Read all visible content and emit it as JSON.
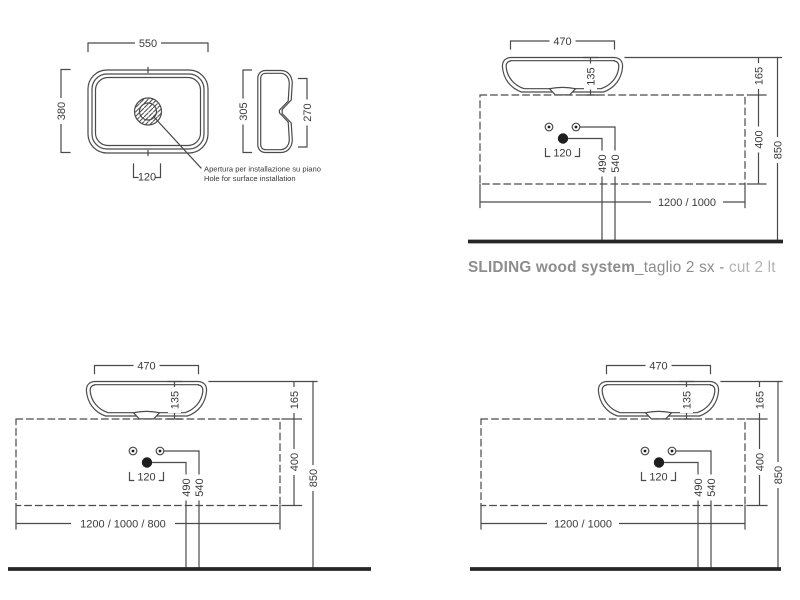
{
  "colors": {
    "background": "#ffffff",
    "line": "#4a4a4a",
    "floor": "#262626",
    "dim_text": "#3a3a3a",
    "caption_primary": "#8d8d8d",
    "caption_secondary": "#b3b3b3"
  },
  "caption": {
    "product": "SLIDING wood system",
    "cut_it": "_taglio 2 sx - ",
    "cut_en": "cut 2 lt"
  },
  "plan_view": {
    "width": "550",
    "depth": "380",
    "hole_width": "120",
    "note_line1": "Apertura per installazione su piano",
    "note_line2": "Hole for surface installation"
  },
  "side_view": {
    "height_total": "305",
    "height_inner": "270"
  },
  "elevations": {
    "top_right": {
      "basin_width": "470",
      "basin_height": "135",
      "rim_above_console": "165",
      "console_height": "400",
      "total_height": "850",
      "mixer_height": "490",
      "fixings_height": "540",
      "fixings_spacing": "120",
      "console_lengths": "1200 / 1000"
    },
    "bottom_left": {
      "basin_width": "470",
      "basin_height": "135",
      "rim_above_console": "165",
      "console_height": "400",
      "total_height": "850",
      "mixer_height": "490",
      "fixings_height": "540",
      "fixings_spacing": "120",
      "console_lengths": "1200 / 1000 / 800"
    },
    "bottom_right": {
      "basin_width": "470",
      "basin_height": "135",
      "rim_above_console": "165",
      "console_height": "400",
      "total_height": "850",
      "mixer_height": "490",
      "fixings_height": "540",
      "fixings_spacing": "120",
      "console_lengths": "1200 / 1000"
    }
  }
}
